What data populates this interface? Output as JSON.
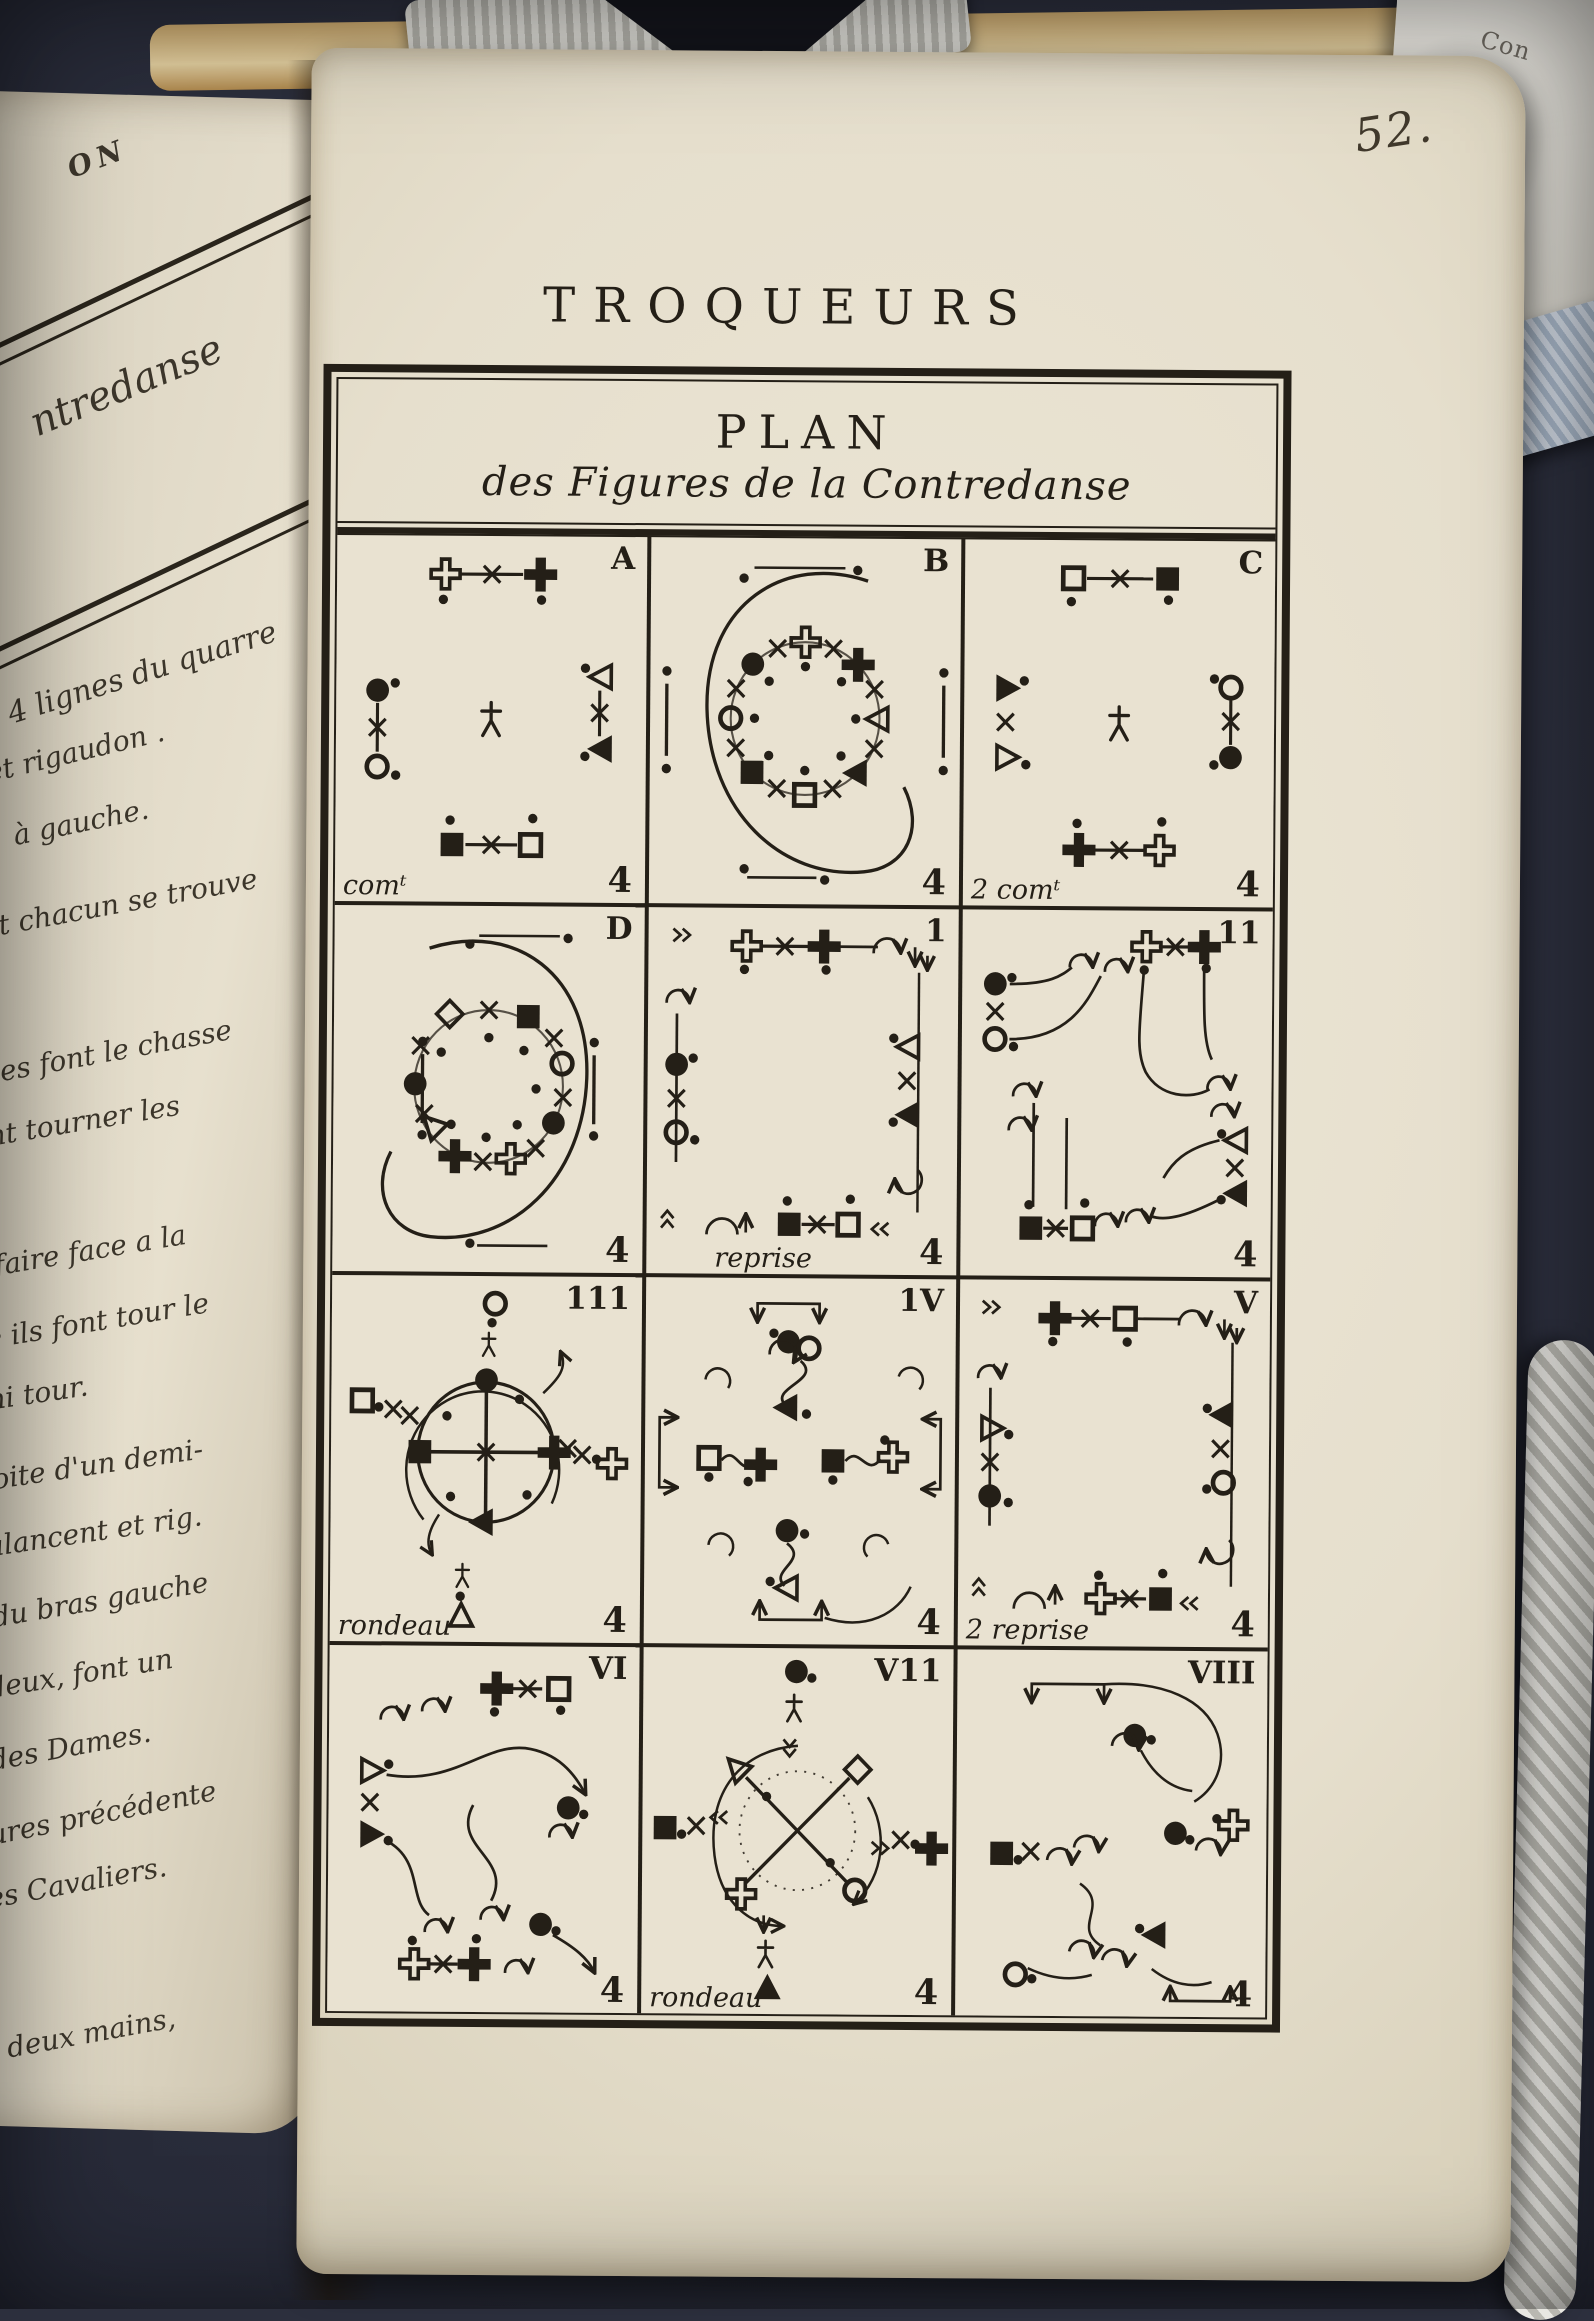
{
  "photo": {
    "page_number": "52.",
    "running_title": "TROQUEURS",
    "corner_fragment_text": "Con"
  },
  "left_page": {
    "lines": [
      "ON",
      "ntredanse",
      "4 lignes du quarre",
      "et rigaudon .",
      "à gauche.",
      "et chacun se trouve",
      "mes font le chasse",
      "ont tourner les",
      "n faire face a la",
      "ite ils font tour le",
      "emi tour.",
      "droite d'un demi-",
      "balancent et rig.",
      "le du bras gauche",
      "is deux, font un",
      "te des Dames.",
      "figures précédente",
      "it les Cavaliers.",
      "es deux mains,"
    ]
  },
  "plan": {
    "title": "PLAN",
    "subtitle": "des Figures de la Contredanse",
    "cells": [
      {
        "corner": "A",
        "caption": "comᵗ",
        "count": "4"
      },
      {
        "corner": "B",
        "caption": "",
        "count": "4"
      },
      {
        "corner": "C",
        "caption": "2 comᵗ",
        "count": "4"
      },
      {
        "corner": "D",
        "caption": "",
        "count": "4"
      },
      {
        "corner": "1",
        "caption": "reprise",
        "count": "4"
      },
      {
        "corner": "11",
        "caption": "",
        "count": "4"
      },
      {
        "corner": "111",
        "caption": "rondeau",
        "count": "4"
      },
      {
        "corner": "1V",
        "caption": "",
        "count": "4"
      },
      {
        "corner": "V",
        "caption": "2 reprise",
        "count": "4"
      },
      {
        "corner": "VI",
        "caption": "",
        "count": "4"
      },
      {
        "corner": "V11",
        "caption": "rondeau",
        "count": "4"
      },
      {
        "corner": "VIII",
        "caption": "",
        "count": "4"
      }
    ]
  },
  "colors": {
    "ink": "#241f17",
    "paper": "#e9e2d1",
    "background": "#2c2f3d"
  }
}
